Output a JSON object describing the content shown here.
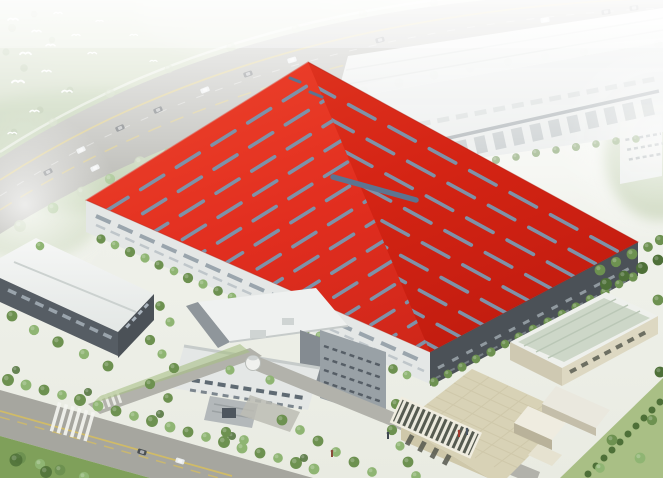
{
  "image": {
    "kind": "aerial architectural rendering",
    "description": "Bird's-eye rendering of an industrial campus: a huge factory hall with a bright red roof covered in diagonal skylight strips sits at the center, a long white production hall lies behind it, smaller white and beige auxiliary buildings sit in front, tree-lined roads with crosswalks and traffic surround the site, and white birds fly over hazy woodland at the top left."
  },
  "palette": {
    "red_roof_light": "#ef3d26",
    "red_roof": "#e02616",
    "red_roof_deep": "#cc1e10",
    "skylight": "#7e92a8",
    "skylight_ridge": "#5d7490",
    "white_roof": "#f0f2f1",
    "white_roof_shade": "#dde1e0",
    "facade_light": "#e4e7e6",
    "facade_mid": "#99a1a6",
    "facade_dark": "#4b5157",
    "window_light": "#aab4bd",
    "window_dark": "#6b7480",
    "road": "#a6a69f",
    "road_minor": "#b2b2ab",
    "lane_yellow": "#d8bf5e",
    "crosswalk": "#f4f5f0",
    "tree_hazy": "#bdccab",
    "tree_dark": "#4e7038",
    "tree_mid": "#6d9150",
    "tree_light": "#8fb573",
    "lawn": "#7fa05a",
    "lawn_light": "#a9bf85",
    "green_roof": "#cdd7c8",
    "beige_roof": "#d8d2b6",
    "beige_wall": "#cfc8aa",
    "cream_wall": "#ddd8c2",
    "bird_white": "#ffffff",
    "car_dark": "#4a4f53",
    "car_light": "#e8ebec",
    "haze": "#ffffff"
  },
  "scene": {
    "areas": [
      {
        "id": "woodland",
        "label": "hazy woodland with flying birds",
        "position": "top-left"
      },
      {
        "id": "highway",
        "label": "arterial road with yellow lane lines and traffic",
        "position": "top"
      },
      {
        "id": "rear-hall",
        "label": "long white production hall with loading bays",
        "position": "top-right"
      },
      {
        "id": "main-hall",
        "label": "main factory hall, red roof with herringbone skylight strips",
        "position": "center"
      },
      {
        "id": "warehouse",
        "label": "white warehouse with ridge roof",
        "position": "left"
      },
      {
        "id": "rd-block",
        "label": "multi-volume R&D / production block with entrance canopy",
        "position": "bottom-center"
      },
      {
        "id": "green-roof-building",
        "label": "long storage building with pale green roof",
        "position": "right"
      },
      {
        "id": "office",
        "label": "beige administration building with rooftop pergola",
        "position": "bottom-right"
      },
      {
        "id": "campus-roads",
        "label": "tree-lined roads with crosswalks, gatehouse and lawns",
        "position": "bottom-left"
      }
    ],
    "counts": {
      "birds": 15,
      "highway_cars": 12,
      "campus_cars": 2,
      "skylight_rows_left": 14,
      "skylight_rows_right": 9
    }
  }
}
